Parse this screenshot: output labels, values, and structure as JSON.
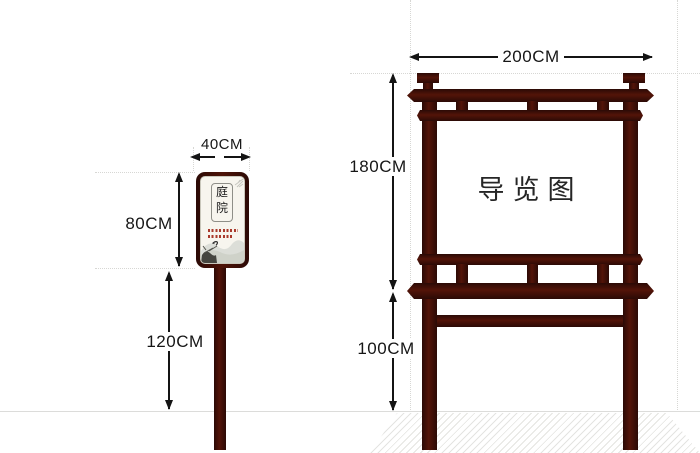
{
  "diagram": {
    "left_sign": {
      "width_label": "40CM",
      "board_height_label": "80CM",
      "pole_height_label": "120CM",
      "plaque_char_top": "庭",
      "plaque_char_bottom": "院"
    },
    "right_sign": {
      "width_label": "200CM",
      "board_height_label": "180CM",
      "leg_height_label": "100CM",
      "board_title": "导览图"
    },
    "colors": {
      "wood": "#3a0e09",
      "dimension_ink": "#141414",
      "panel_cream": "#f7f5ee",
      "guide_gray": "#d7d7d4",
      "hatch_gray": "#e4e4e1"
    }
  }
}
